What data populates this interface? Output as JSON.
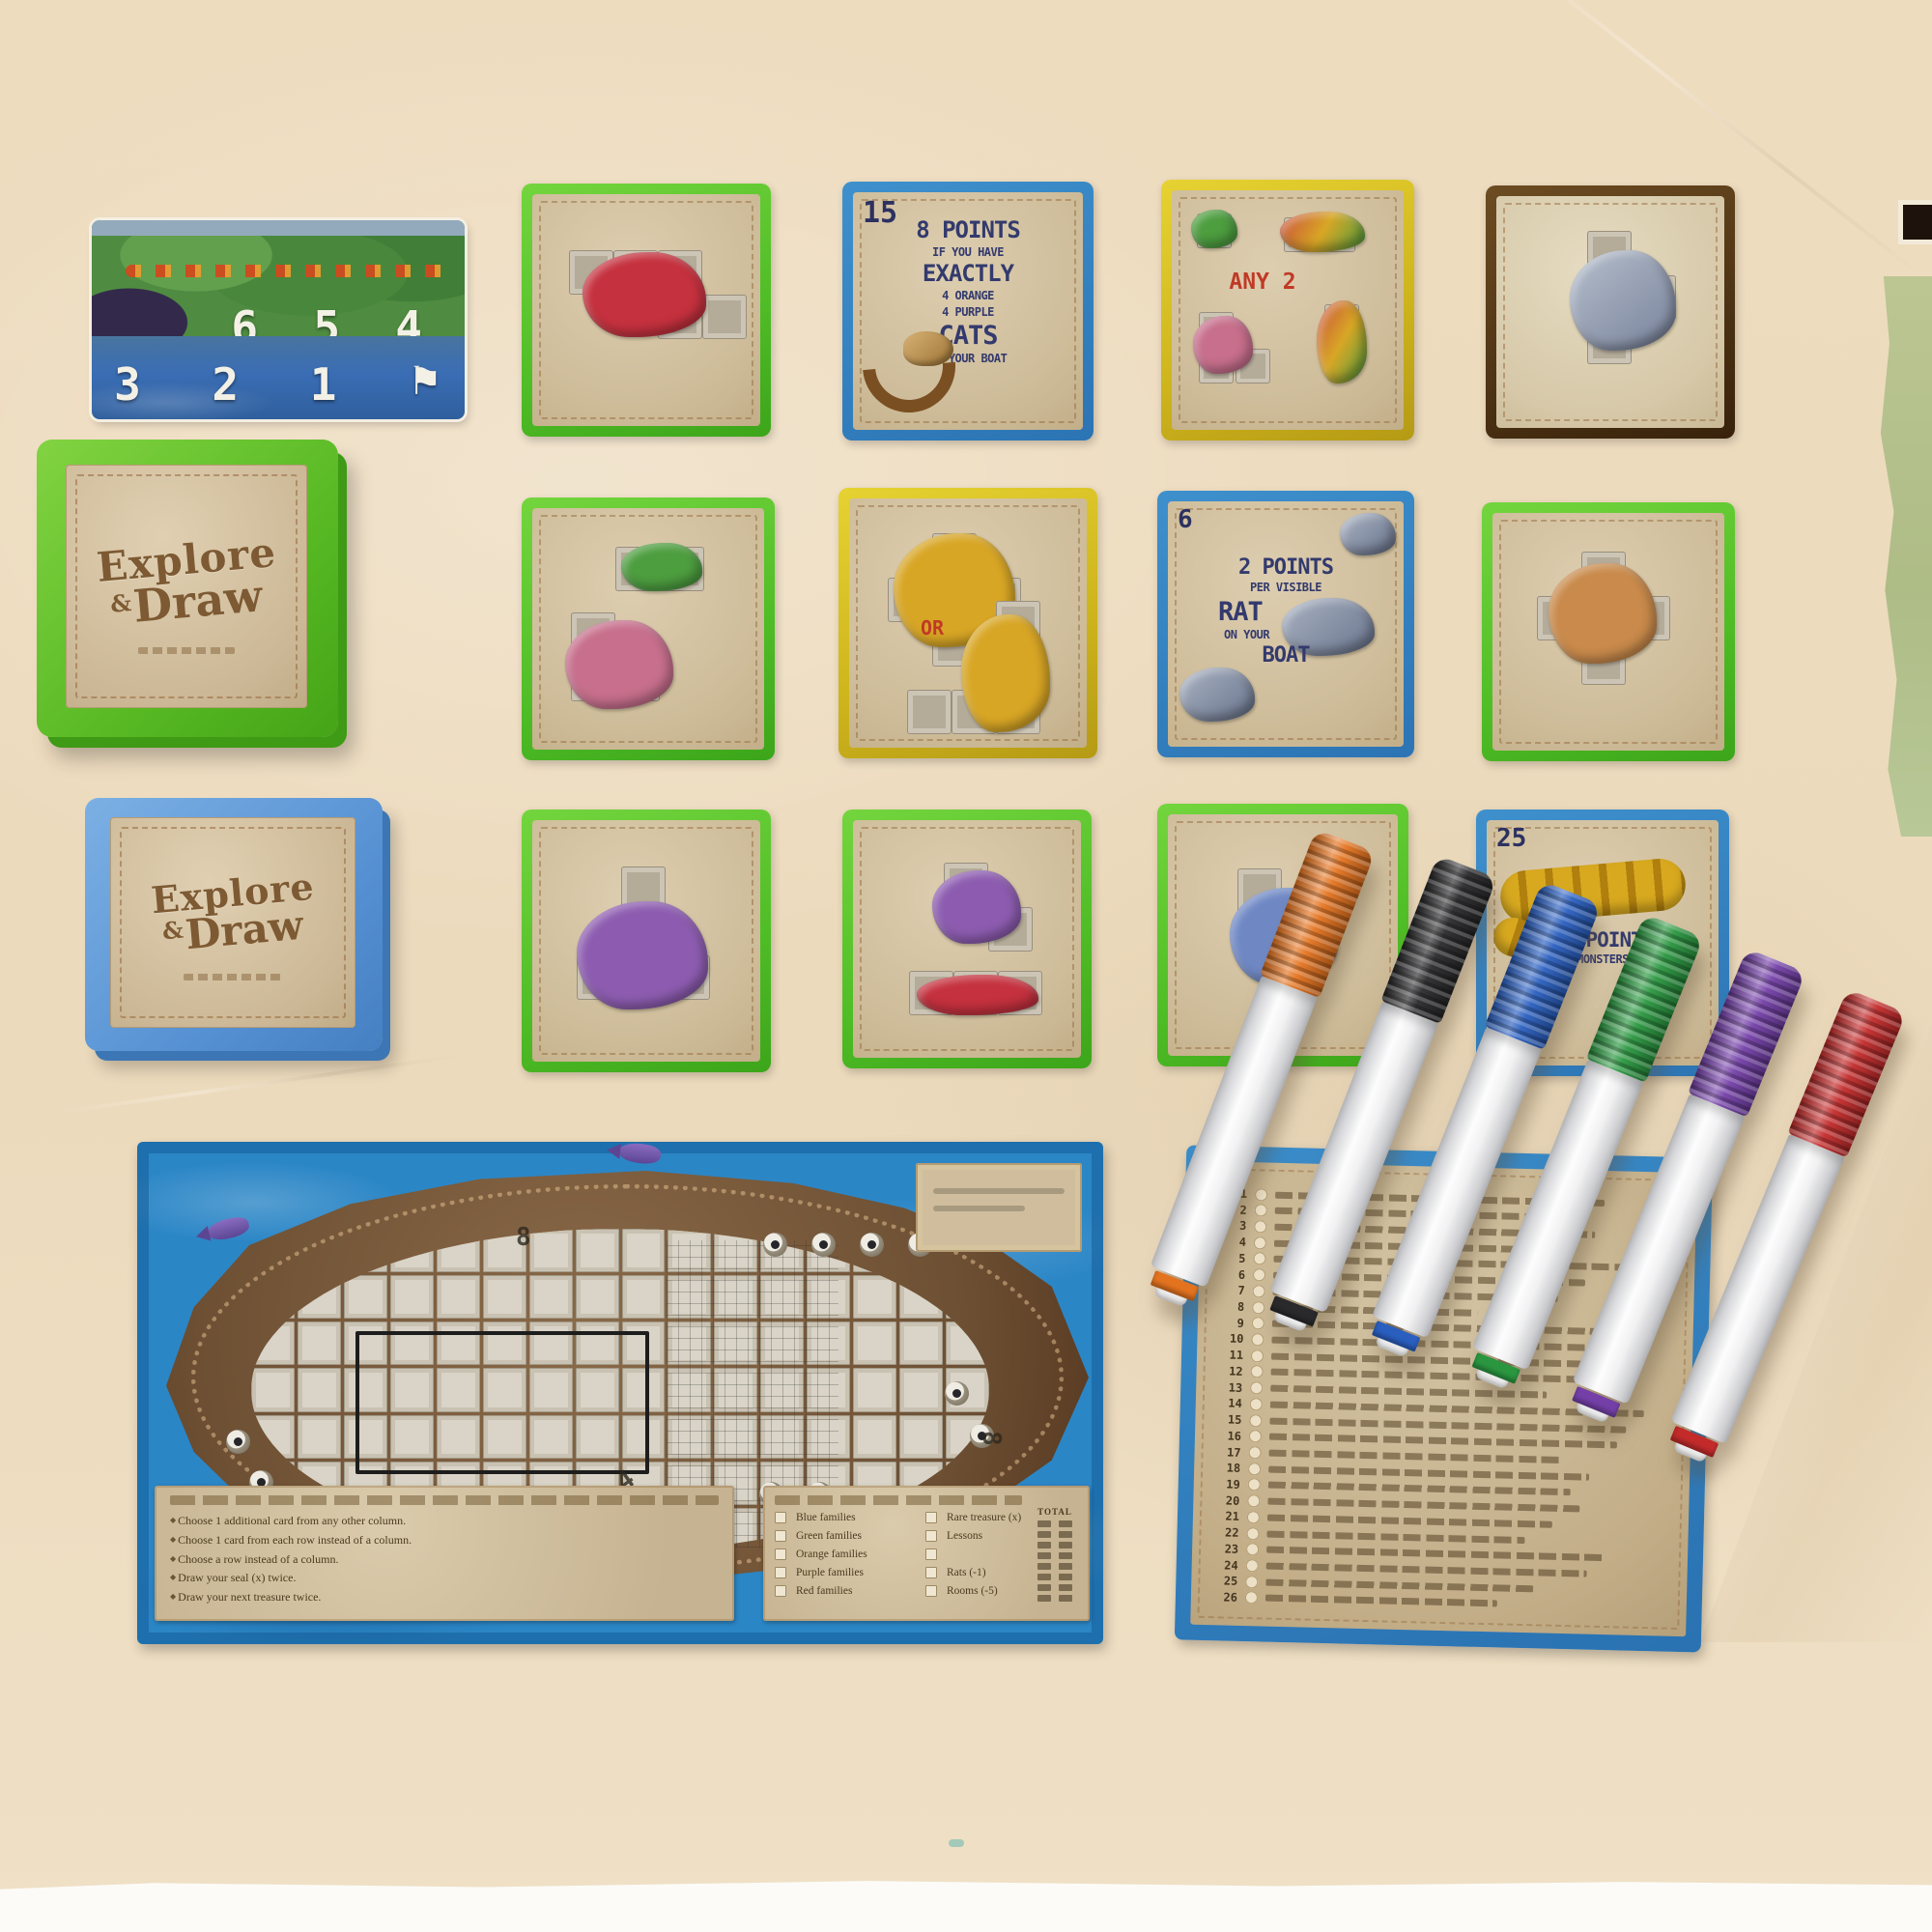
{
  "product": {
    "name": "Explore & Draw"
  },
  "colors": {
    "background": "#eedcbf",
    "sage_paper": "#b7c28e",
    "card_green": "#55c133",
    "card_blue": "#2f7fc1",
    "card_gold": "#d9c428",
    "card_brown": "#4b2f12",
    "board_blue": "#2b86c6",
    "parchment": "#d3c1a0",
    "text_navy": "#333a6d",
    "text_red": "#c03a26"
  },
  "tracker": {
    "top": [
      "6",
      "5",
      "4"
    ],
    "bottom": [
      "3",
      "2",
      "1"
    ],
    "flag": "⚑"
  },
  "deck_green": {
    "word1": "Explore",
    "amp": "&",
    "word2": "Draw"
  },
  "deck_blue": {
    "word1": "Explore",
    "amp": "&",
    "word2": "Draw"
  },
  "cards": {
    "r1c2": {
      "corner": "15",
      "lines": [
        "8 POINTS",
        "IF YOU HAVE",
        "EXACTLY",
        "4 ORANGE",
        "4 PURPLE",
        "CATS",
        "ON YOUR BOAT"
      ]
    },
    "r1c3": {
      "label": "ANY 2"
    },
    "r2c2": {
      "label": "OR"
    },
    "r2c3": {
      "corner": "6",
      "lines": [
        "2 POINTS",
        "PER VISIBLE",
        "RAT",
        "ON YOUR",
        "BOAT"
      ]
    },
    "r3c4": {
      "corner": "25",
      "lines": [
        "10 POINTS",
        "MONSTERS"
      ]
    }
  },
  "ship_board": {
    "actions": [
      "Choose 1 additional card from any other column.",
      "Choose 1 card from each row instead of a column.",
      "Choose a row instead of a column.",
      "Draw your seal (x) twice.",
      "Draw your next treasure twice."
    ],
    "scoring_left": [
      "Blue families",
      "Green families",
      "Orange families",
      "Purple families",
      "Red families"
    ],
    "scoring_right": [
      "Rare treasure (x)",
      "Lessons",
      "",
      "Rats (-1)",
      "Rooms (-5)"
    ],
    "total_label": "TOTAL",
    "deck_digits": [
      "8",
      "4",
      "8"
    ]
  },
  "score_sheet": {
    "row_numbers": [
      "1",
      "2",
      "3",
      "4",
      "5",
      "6",
      "7",
      "8",
      "9",
      "10",
      "11",
      "12",
      "13",
      "14",
      "15",
      "16",
      "17",
      "18",
      "19",
      "20",
      "21",
      "22",
      "23",
      "24",
      "25",
      "26"
    ]
  },
  "markers": [
    {
      "name": "orange",
      "hex": "#e4731f"
    },
    {
      "name": "black",
      "hex": "#2a2a2c"
    },
    {
      "name": "blue",
      "hex": "#2a5fc0"
    },
    {
      "name": "green",
      "hex": "#2a9740"
    },
    {
      "name": "purple",
      "hex": "#7440a8"
    },
    {
      "name": "red",
      "hex": "#c32b2b"
    }
  ]
}
